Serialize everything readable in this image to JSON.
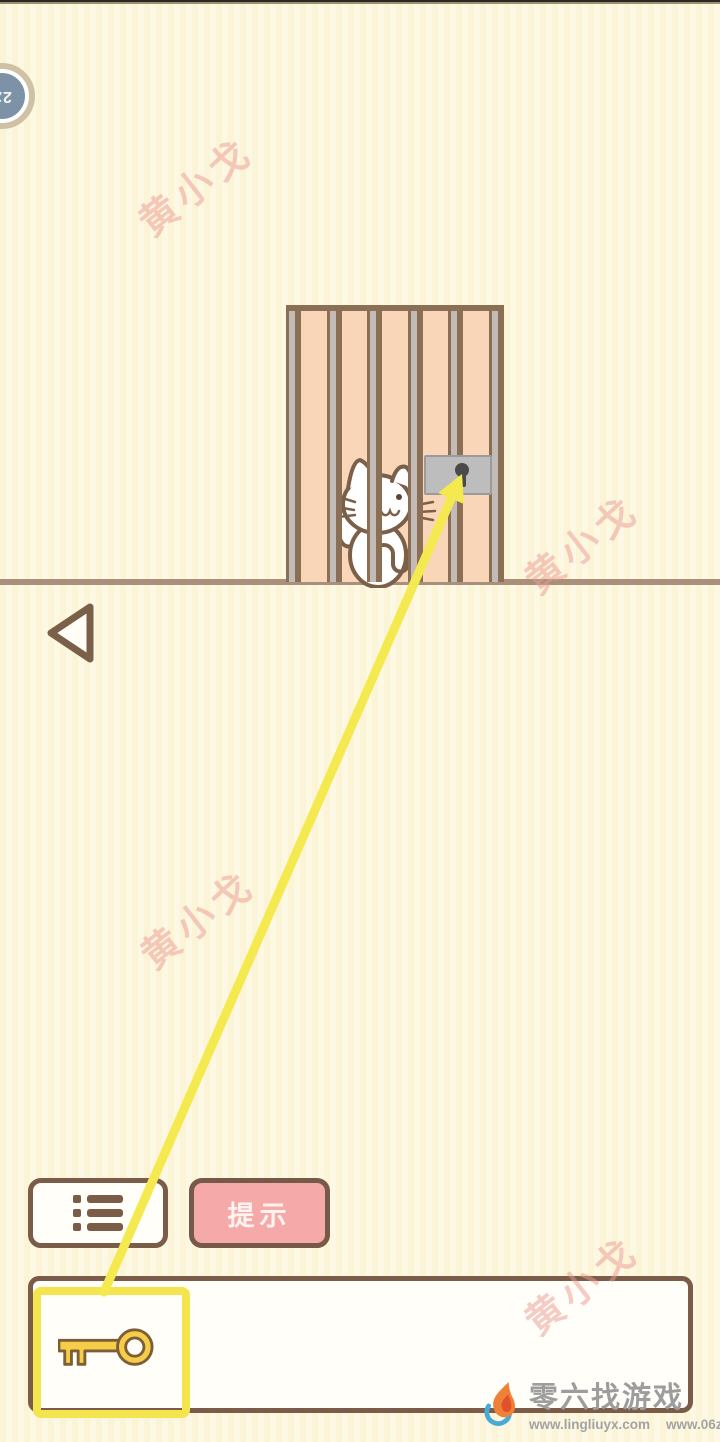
{
  "window": {
    "width": 720,
    "height": 1442
  },
  "level_badge": {
    "label": "22"
  },
  "watermark": {
    "text": "黄小戈"
  },
  "scene": {
    "cat": "white cat behind cage bars",
    "lock": "gray padlock plate with keyhole",
    "hint_arrow": "yellow arrow from key item to lock"
  },
  "toolbar": {
    "hint_label": "提示"
  },
  "inventory": {
    "selected_item": "key",
    "slot_count_visible": 1
  },
  "footer": {
    "site_name": "零六找游戏",
    "url_left": "www.lingliuyx.com",
    "url_right": "www.06zyx.com"
  },
  "colors": {
    "background": "#fcf6dc",
    "ui_brown": "#7a5c49",
    "cage_brown": "#8a6f55",
    "cage_peach": "#f9d6b7",
    "bar_gray": "#c3bbb7",
    "lock_gray": "#bdbdbd",
    "highlight_yellow": "#f4e44e",
    "key_gold": "#f5cd49",
    "hint_pink": "#f5a9a9",
    "ground": "#a8907a",
    "watermark_pink": "#eb9a90",
    "badge_blue": "#7d92a7"
  }
}
